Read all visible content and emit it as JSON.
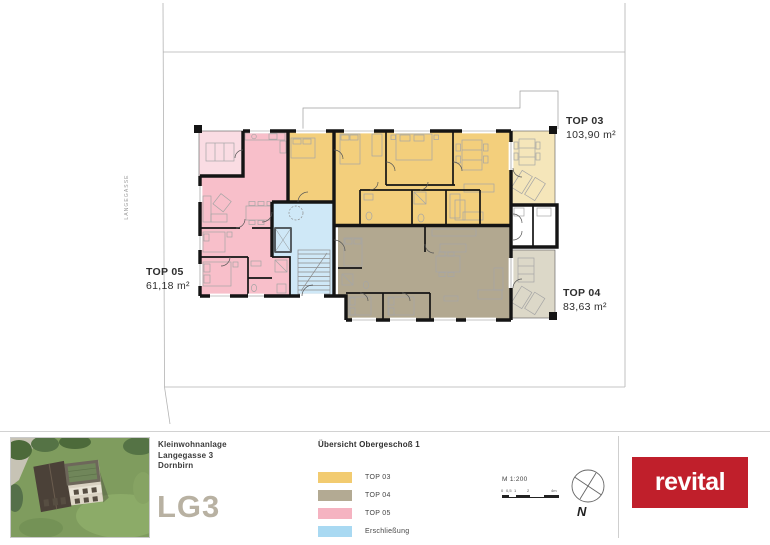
{
  "site": {
    "street_label": "LANGEGASSE"
  },
  "plan": {
    "colors": {
      "top03": "#f3cf7c",
      "top03_outdoor": "#f5e6ba",
      "top04": "#b2a890",
      "top04_outdoor": "#dcd8c8",
      "top05": "#f8bfca",
      "top05_outdoor": "#fadce3",
      "circulation": "#cfe8f7"
    },
    "units": [
      {
        "label": "TOP 03",
        "area": "103,90 m²"
      },
      {
        "label": "TOP 04",
        "area": "83,63 m²"
      },
      {
        "label": "TOP 05",
        "area": "61,18 m²"
      }
    ]
  },
  "footer": {
    "project": {
      "line1": "Kleinwohnanlage",
      "line2": "Langegasse 3",
      "line3": "Dornbirn",
      "code": "LG3"
    },
    "sheet_title": "Übersicht Obergeschoß 1",
    "legend": [
      {
        "label": "TOP 03",
        "color": "#f2cb70"
      },
      {
        "label": "TOP 04",
        "color": "#b3aa93"
      },
      {
        "label": "TOP 05",
        "color": "#f5b3c1"
      },
      {
        "label": "Erschließung",
        "color": "#a9d9f2"
      }
    ],
    "scale": {
      "label": "M 1:200",
      "ticks": [
        "0",
        "0,5",
        "1",
        "2",
        "4m"
      ]
    },
    "north_label": "N",
    "logo": {
      "text": "revital",
      "color": "#c01f2b"
    }
  }
}
